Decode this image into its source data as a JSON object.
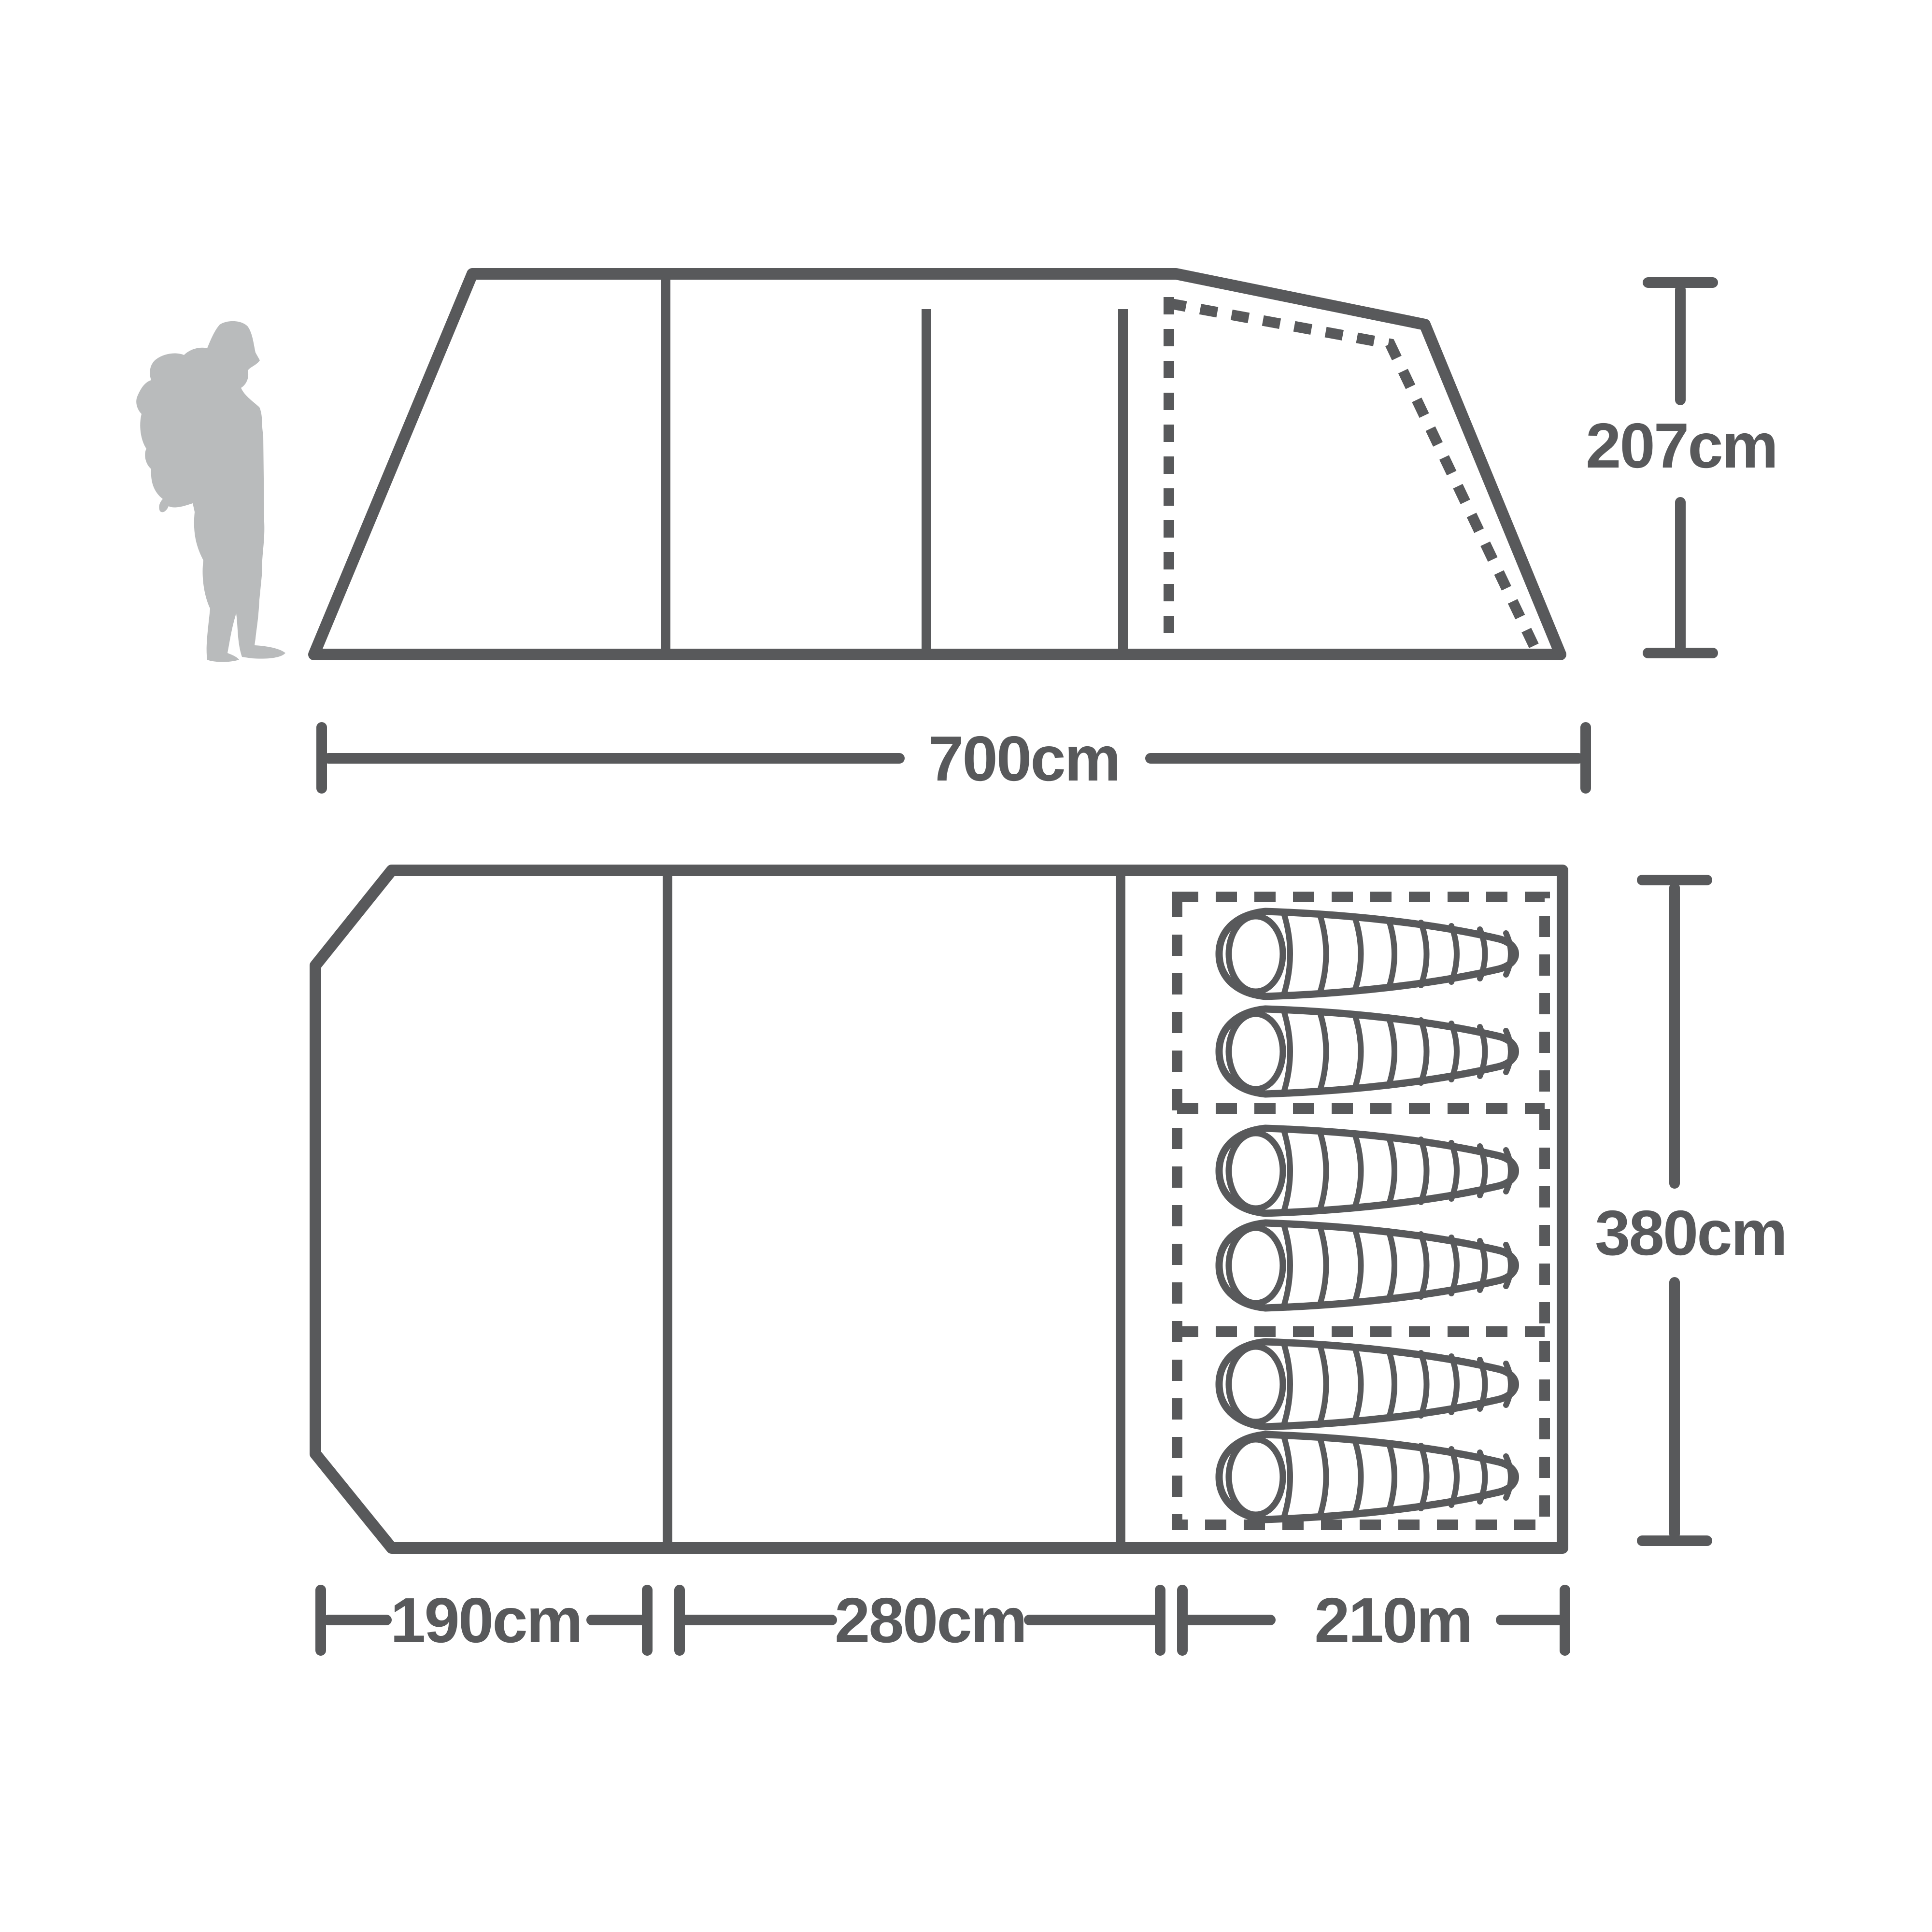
{
  "canvas": {
    "background": "#ffffff",
    "line_color": "#58595b",
    "silhouette_color": "#b9bbbc"
  },
  "side_view": {
    "description": "tent side elevation with hiker silhouette for scale",
    "height_label": "207cm",
    "length_label": "700cm"
  },
  "floor_plan": {
    "description": "tent floor plan with sleeping area",
    "depth_label": "380cm",
    "porch_label": "190cm",
    "living_label": "280cm",
    "bedroom_label": "210m",
    "sleeping_bag_count": 6,
    "bedroom_compartments": 3
  },
  "icons": {
    "hiker": "hiker-silhouette-icon",
    "sleeping_bag": "sleeping-bag-icon"
  }
}
